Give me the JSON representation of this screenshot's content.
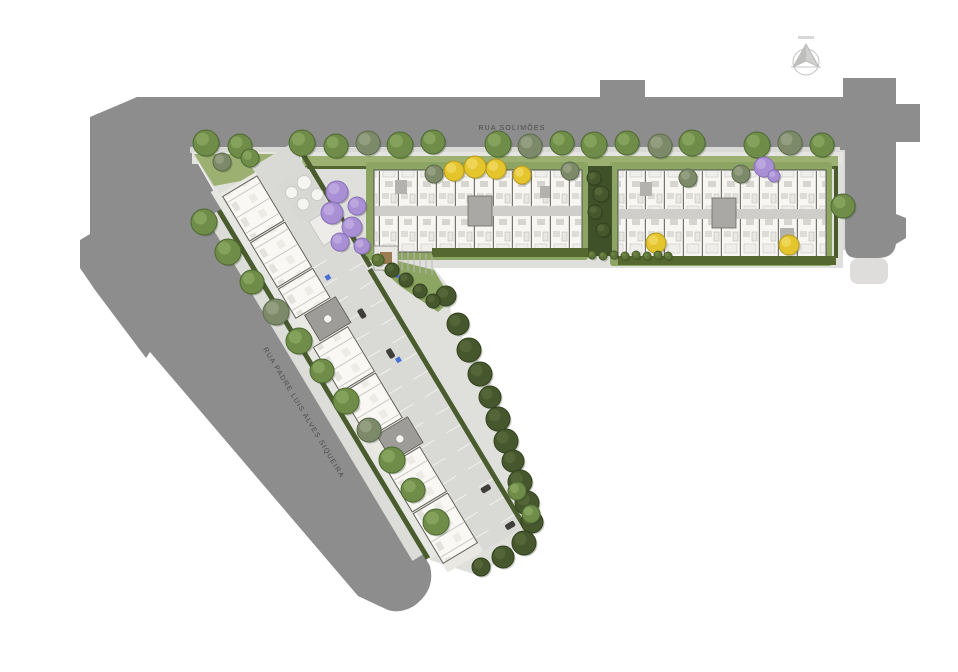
{
  "scene": {
    "type": "architectural-site-plan",
    "view": "top-down masterplan of L-shaped residential development"
  },
  "streets": {
    "top": "RUA SOLIMÕES",
    "diagonal": "RUA PADRE LUIS ALVES SIQUEIRA"
  },
  "compass": {
    "icon": "north-arrow-icon"
  },
  "colors": {
    "road": "#8d8d8d",
    "sidewalk": "#d9d9d6",
    "site_pavement": "#dfdfdc",
    "grass": "#8ca562",
    "grass_light": "#9cb171",
    "hedge": "#4a5c2e",
    "hedge_dark": "#3f5129",
    "slab_white": "#f9f8f4",
    "core_gray": "#9d9c99",
    "accessible_blue": "#4a6fd4",
    "tree_types": {
      "g": {
        "fill": "#6f8d49",
        "stroke": "#4e6a33",
        "hi": "#8aa65f"
      },
      "o": {
        "fill": "#7d8a6a",
        "stroke": "#5d6b4e",
        "hi": "#95a183"
      },
      "d": {
        "fill": "#46572e",
        "stroke": "#33421f",
        "hi": "#57693a"
      },
      "y": {
        "fill": "#e5c52e",
        "stroke": "#b89a1f",
        "hi": "#f0d75c"
      },
      "p": {
        "fill": "#a98fd4",
        "stroke": "#8a70b8",
        "hi": "#bfaae2"
      },
      "b": {
        "fill": "#5d7438",
        "stroke": "#465a28",
        "hi": "#6e8647"
      }
    }
  },
  "trees": [
    {
      "x": 206,
      "y": 143,
      "r": 13,
      "t": "g"
    },
    {
      "x": 240,
      "y": 146,
      "r": 12,
      "t": "g"
    },
    {
      "x": 302,
      "y": 143,
      "r": 13,
      "t": "g"
    },
    {
      "x": 336,
      "y": 146,
      "r": 12,
      "t": "g"
    },
    {
      "x": 368,
      "y": 143,
      "r": 12,
      "t": "o"
    },
    {
      "x": 400,
      "y": 145,
      "r": 13,
      "t": "g"
    },
    {
      "x": 433,
      "y": 142,
      "r": 12,
      "t": "g"
    },
    {
      "x": 498,
      "y": 144,
      "r": 13,
      "t": "g"
    },
    {
      "x": 530,
      "y": 146,
      "r": 12,
      "t": "o"
    },
    {
      "x": 562,
      "y": 143,
      "r": 12,
      "t": "g"
    },
    {
      "x": 594,
      "y": 145,
      "r": 13,
      "t": "g"
    },
    {
      "x": 627,
      "y": 143,
      "r": 12,
      "t": "g"
    },
    {
      "x": 660,
      "y": 146,
      "r": 12,
      "t": "o"
    },
    {
      "x": 692,
      "y": 143,
      "r": 13,
      "t": "g"
    },
    {
      "x": 757,
      "y": 145,
      "r": 13,
      "t": "g"
    },
    {
      "x": 790,
      "y": 143,
      "r": 12,
      "t": "o"
    },
    {
      "x": 822,
      "y": 145,
      "r": 12,
      "t": "g"
    },
    {
      "x": 204,
      "y": 222,
      "r": 13,
      "t": "g"
    },
    {
      "x": 228,
      "y": 252,
      "r": 13,
      "t": "g"
    },
    {
      "x": 252,
      "y": 282,
      "r": 12,
      "t": "g"
    },
    {
      "x": 276,
      "y": 312,
      "r": 13,
      "t": "o"
    },
    {
      "x": 299,
      "y": 341,
      "r": 13,
      "t": "g"
    },
    {
      "x": 322,
      "y": 371,
      "r": 12,
      "t": "g"
    },
    {
      "x": 346,
      "y": 401,
      "r": 13,
      "t": "g"
    },
    {
      "x": 369,
      "y": 430,
      "r": 12,
      "t": "o"
    },
    {
      "x": 392,
      "y": 460,
      "r": 13,
      "t": "g"
    },
    {
      "x": 413,
      "y": 490,
      "r": 12,
      "t": "g"
    },
    {
      "x": 436,
      "y": 522,
      "r": 13,
      "t": "g"
    },
    {
      "x": 446,
      "y": 296,
      "r": 10,
      "t": "d"
    },
    {
      "x": 458,
      "y": 324,
      "r": 11,
      "t": "d"
    },
    {
      "x": 469,
      "y": 350,
      "r": 12,
      "t": "d"
    },
    {
      "x": 480,
      "y": 374,
      "r": 12,
      "t": "d"
    },
    {
      "x": 490,
      "y": 397,
      "r": 11,
      "t": "d"
    },
    {
      "x": 498,
      "y": 419,
      "r": 12,
      "t": "d"
    },
    {
      "x": 506,
      "y": 441,
      "r": 12,
      "t": "d"
    },
    {
      "x": 513,
      "y": 461,
      "r": 11,
      "t": "d"
    },
    {
      "x": 520,
      "y": 482,
      "r": 12,
      "t": "d"
    },
    {
      "x": 527,
      "y": 503,
      "r": 12,
      "t": "d"
    },
    {
      "x": 532,
      "y": 522,
      "r": 11,
      "t": "d"
    },
    {
      "x": 524,
      "y": 543,
      "r": 12,
      "t": "d"
    },
    {
      "x": 503,
      "y": 557,
      "r": 11,
      "t": "d"
    },
    {
      "x": 481,
      "y": 567,
      "r": 9,
      "t": "d"
    },
    {
      "x": 517,
      "y": 491,
      "r": 9,
      "t": "g"
    },
    {
      "x": 531,
      "y": 514,
      "r": 9,
      "t": "g"
    },
    {
      "x": 337,
      "y": 192,
      "r": 11,
      "t": "p"
    },
    {
      "x": 357,
      "y": 206,
      "r": 9,
      "t": "p"
    },
    {
      "x": 332,
      "y": 213,
      "r": 11,
      "t": "p"
    },
    {
      "x": 352,
      "y": 227,
      "r": 10,
      "t": "p"
    },
    {
      "x": 340,
      "y": 242,
      "r": 9,
      "t": "p"
    },
    {
      "x": 362,
      "y": 246,
      "r": 8,
      "t": "p"
    },
    {
      "x": 764,
      "y": 167,
      "r": 10,
      "t": "p"
    },
    {
      "x": 774,
      "y": 176,
      "r": 6,
      "t": "p"
    },
    {
      "x": 454,
      "y": 171,
      "r": 10,
      "t": "y"
    },
    {
      "x": 475,
      "y": 167,
      "r": 11,
      "t": "y"
    },
    {
      "x": 496,
      "y": 169,
      "r": 10,
      "t": "y"
    },
    {
      "x": 522,
      "y": 175,
      "r": 9,
      "t": "y"
    },
    {
      "x": 656,
      "y": 243,
      "r": 10,
      "t": "y"
    },
    {
      "x": 789,
      "y": 245,
      "r": 10,
      "t": "y"
    },
    {
      "x": 434,
      "y": 174,
      "r": 9,
      "t": "o"
    },
    {
      "x": 570,
      "y": 171,
      "r": 9,
      "t": "o"
    },
    {
      "x": 688,
      "y": 178,
      "r": 9,
      "t": "o"
    },
    {
      "x": 741,
      "y": 174,
      "r": 9,
      "t": "o"
    },
    {
      "x": 843,
      "y": 206,
      "r": 12,
      "t": "g"
    },
    {
      "x": 594,
      "y": 178,
      "r": 7,
      "t": "d"
    },
    {
      "x": 601,
      "y": 194,
      "r": 8,
      "t": "d"
    },
    {
      "x": 595,
      "y": 212,
      "r": 7,
      "t": "d"
    },
    {
      "x": 603,
      "y": 230,
      "r": 7,
      "t": "d"
    },
    {
      "x": 392,
      "y": 270,
      "r": 7,
      "t": "d"
    },
    {
      "x": 406,
      "y": 280,
      "r": 7,
      "t": "d"
    },
    {
      "x": 420,
      "y": 291,
      "r": 7,
      "t": "d"
    },
    {
      "x": 433,
      "y": 301,
      "r": 7,
      "t": "d"
    },
    {
      "x": 378,
      "y": 260,
      "r": 6,
      "t": "b"
    },
    {
      "x": 592,
      "y": 255,
      "r": 4,
      "t": "b"
    },
    {
      "x": 603,
      "y": 256,
      "r": 4,
      "t": "b"
    },
    {
      "x": 614,
      "y": 255,
      "r": 4,
      "t": "b"
    },
    {
      "x": 625,
      "y": 256,
      "r": 4,
      "t": "b"
    },
    {
      "x": 636,
      "y": 255,
      "r": 4,
      "t": "b"
    },
    {
      "x": 647,
      "y": 256,
      "r": 4,
      "t": "b"
    },
    {
      "x": 658,
      "y": 255,
      "r": 4,
      "t": "b"
    },
    {
      "x": 668,
      "y": 256,
      "r": 4,
      "t": "b"
    },
    {
      "x": 222,
      "y": 162,
      "r": 9,
      "t": "o"
    },
    {
      "x": 250,
      "y": 158,
      "r": 9,
      "t": "g"
    }
  ],
  "diagonal_strip": {
    "slabs": [
      {
        "x": 10,
        "w": 52
      },
      {
        "x": 64,
        "w": 52
      },
      {
        "x": 118,
        "w": 34
      },
      {
        "x": 186,
        "w": 52
      },
      {
        "x": 240,
        "w": 52
      },
      {
        "x": 326,
        "w": 52
      },
      {
        "x": 380,
        "w": 58
      }
    ],
    "cores": [
      {
        "x": 154
      },
      {
        "x": 294
      }
    ],
    "parking": {
      "x_from": 118,
      "x_to": 440,
      "step": 21,
      "rows": [
        {
          "y": 9,
          "h": 16
        },
        {
          "y": 39,
          "h": 16
        }
      ]
    },
    "cars": [
      {
        "x": 177,
        "y": 33,
        "w": 10,
        "h": 6
      },
      {
        "x": 226,
        "y": 29,
        "w": 10,
        "h": 6
      },
      {
        "x": 393,
        "y": 15,
        "w": 6,
        "h": 10
      },
      {
        "x": 437,
        "y": 13,
        "w": 6,
        "h": 10
      }
    ],
    "accessible_markers": [
      {
        "x": 131,
        "y": 44
      },
      {
        "x": 238,
        "y": 26
      }
    ],
    "amenity_circles": [
      {
        "x": 40,
        "y": 18,
        "r": 7
      },
      {
        "x": 57,
        "y": 13,
        "r": 6
      },
      {
        "x": 42,
        "y": 34,
        "r": 6
      },
      {
        "x": 58,
        "y": 30,
        "r": 6
      }
    ]
  },
  "garden": {
    "flower_dots": [
      {
        "x": 398,
        "y": 276
      },
      {
        "x": 416,
        "y": 290
      }
    ]
  }
}
